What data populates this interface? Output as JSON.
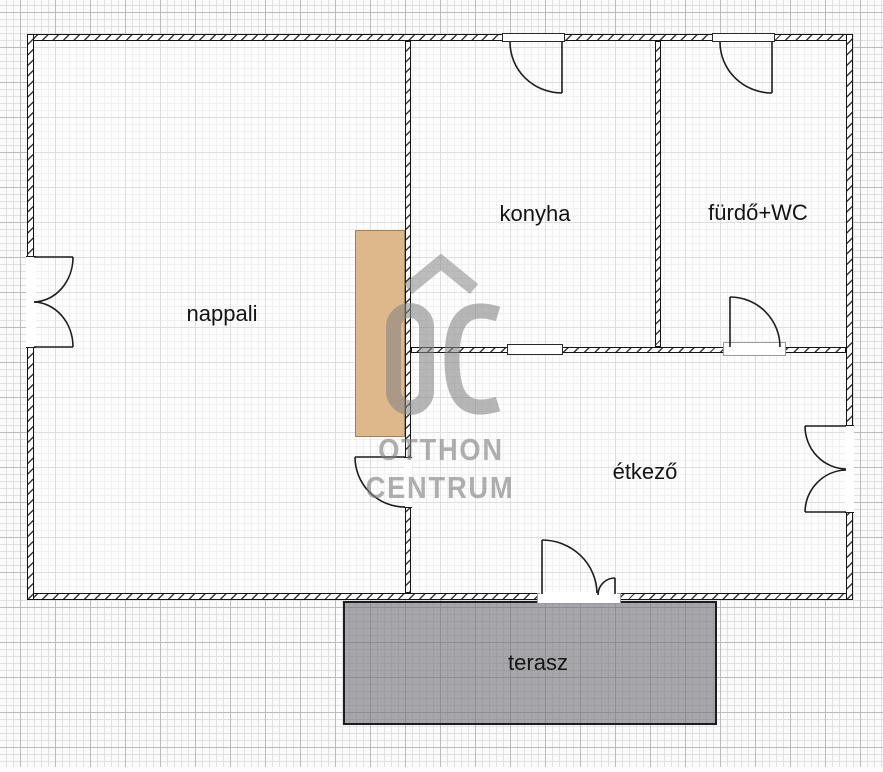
{
  "floorplan": {
    "rooms": [
      {
        "id": "nappali",
        "label": "nappali"
      },
      {
        "id": "konyha",
        "label": "konyha"
      },
      {
        "id": "furdo-wc",
        "label": "fürdő+WC"
      },
      {
        "id": "etkezo",
        "label": "étkező"
      }
    ],
    "outdoor": {
      "terrace_label": "terasz"
    },
    "watermark": {
      "monogram": "OC",
      "line1": "OTTHON",
      "line2": "CENTRUM"
    },
    "colors": {
      "wall_line": "#141414",
      "furniture_tan": "#ddb88a",
      "furniture_tan_border": "#a5814f",
      "terrace_gray": "#8f8f94",
      "watermark_gray": "#8a8a8a",
      "grid_minor": "#e1e1e1",
      "grid_major": "#bcbcbc",
      "label_text": "#141414"
    }
  }
}
